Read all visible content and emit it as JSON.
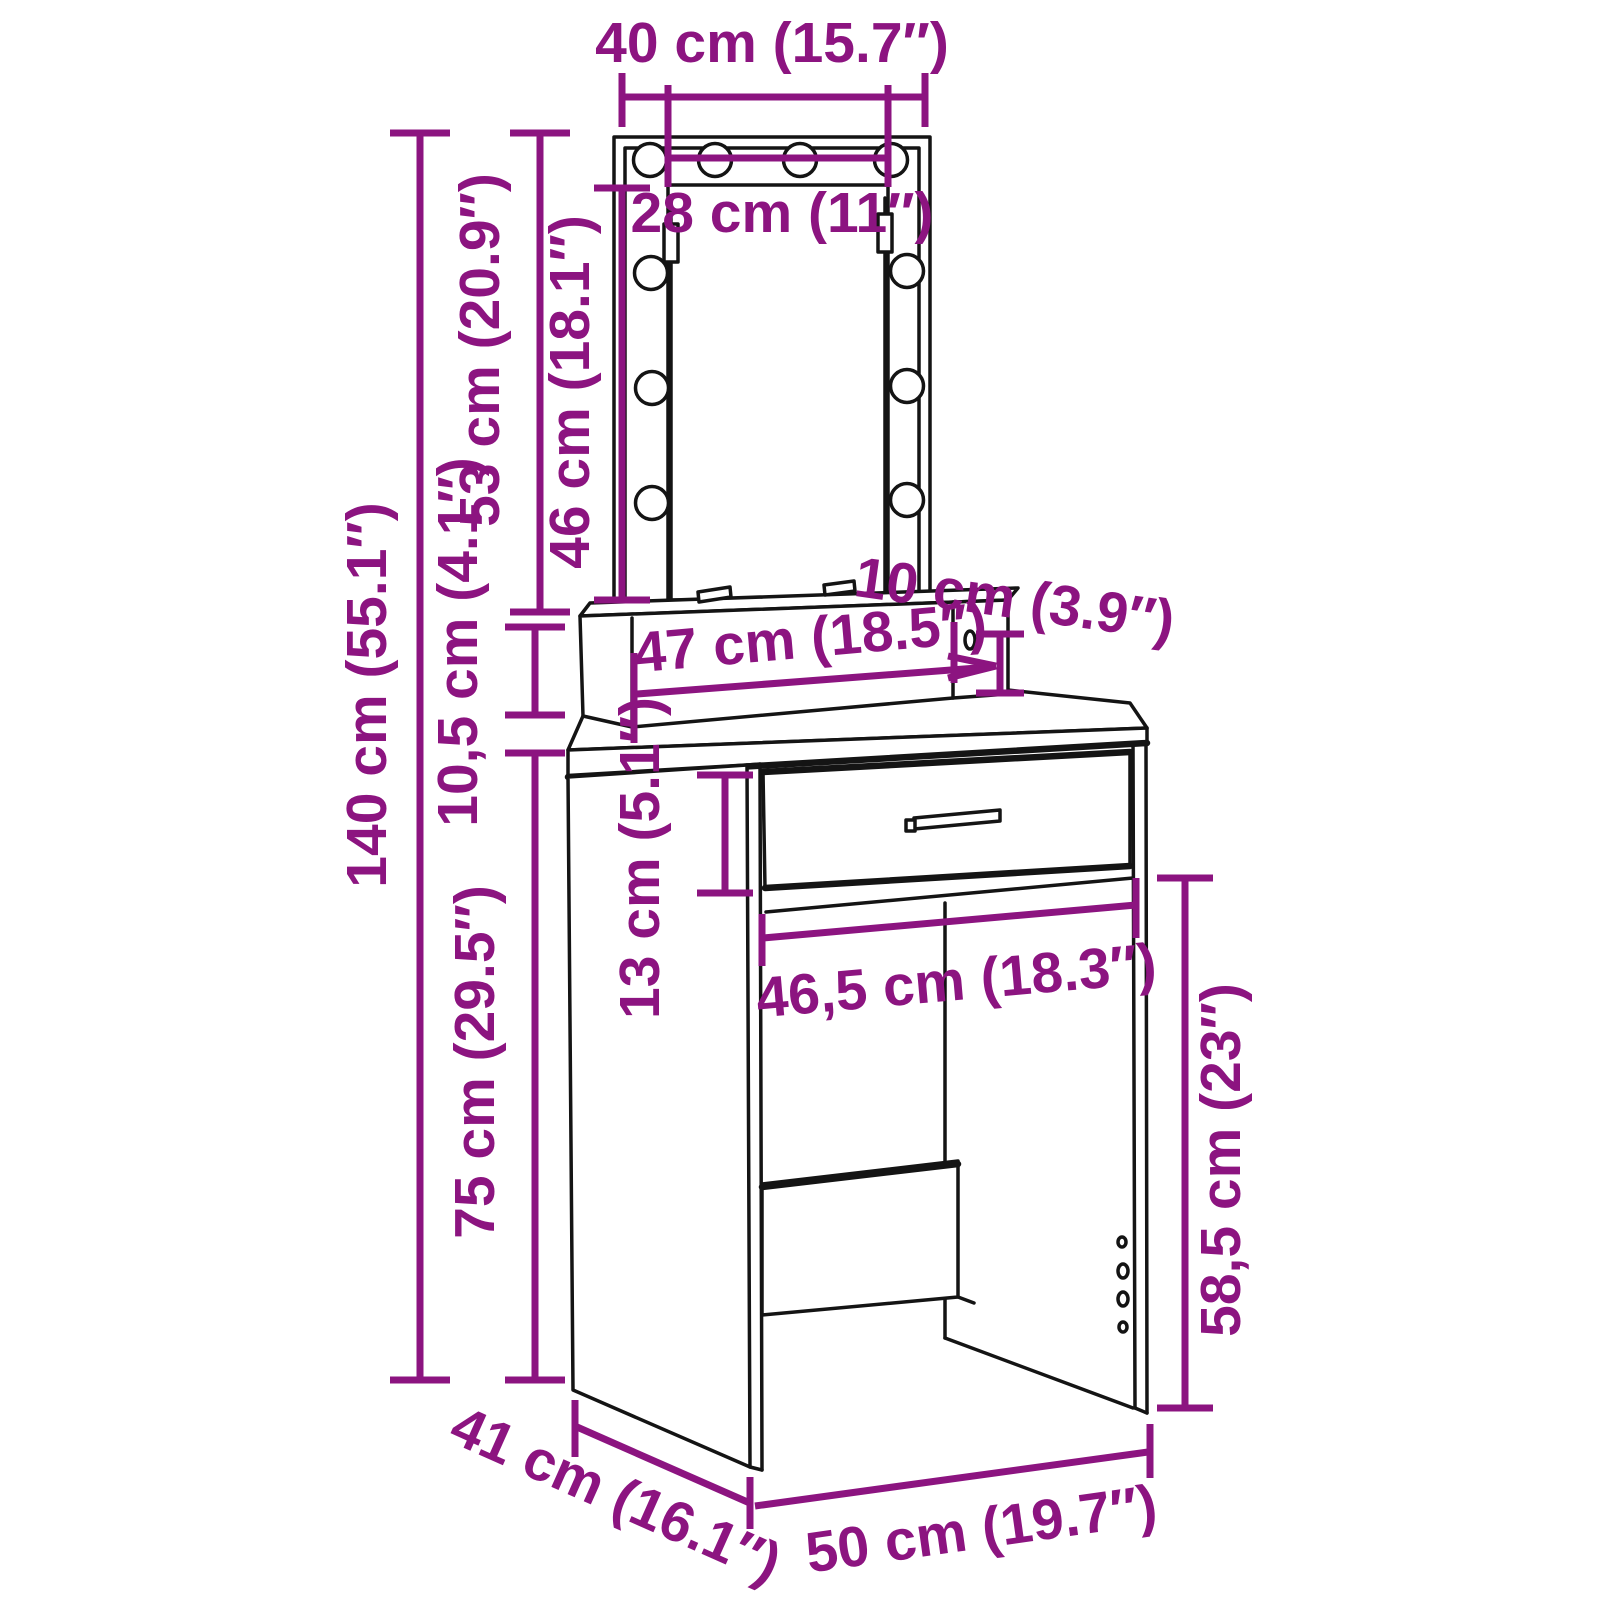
{
  "diagram": {
    "type": "furniture-dimension-diagram",
    "product": "Dressing table with LED mirror and drawer",
    "colors": {
      "dimension_annotation": "#8C1480",
      "outline": "#141414",
      "background": "#FFFFFF"
    },
    "units": [
      "cm",
      "inch"
    ],
    "led_bulb_count": 10,
    "dimensions": {
      "mirror_width": "40 cm (15.7″)",
      "mirror_inner_width": "28 cm (11″)",
      "mirror_height": "53 cm (20.9″)",
      "mirror_inner_height": "46 cm (18.1″)",
      "total_height": "140 cm (55.1″)",
      "shelf_riser_height": "10,5 cm (4.1″)",
      "desk_height": "75 cm (29.5″)",
      "drawer_height": "13 cm (5.1″)",
      "shelf_width": "47 cm (18.5″)",
      "shelf_height": "10 cm (3.9″)",
      "opening_width": "46,5 cm (18.3″)",
      "legroom_height": "58,5 cm (23″)",
      "depth": "41 cm (16.1″)",
      "width": "50 cm (19.7″)"
    }
  }
}
